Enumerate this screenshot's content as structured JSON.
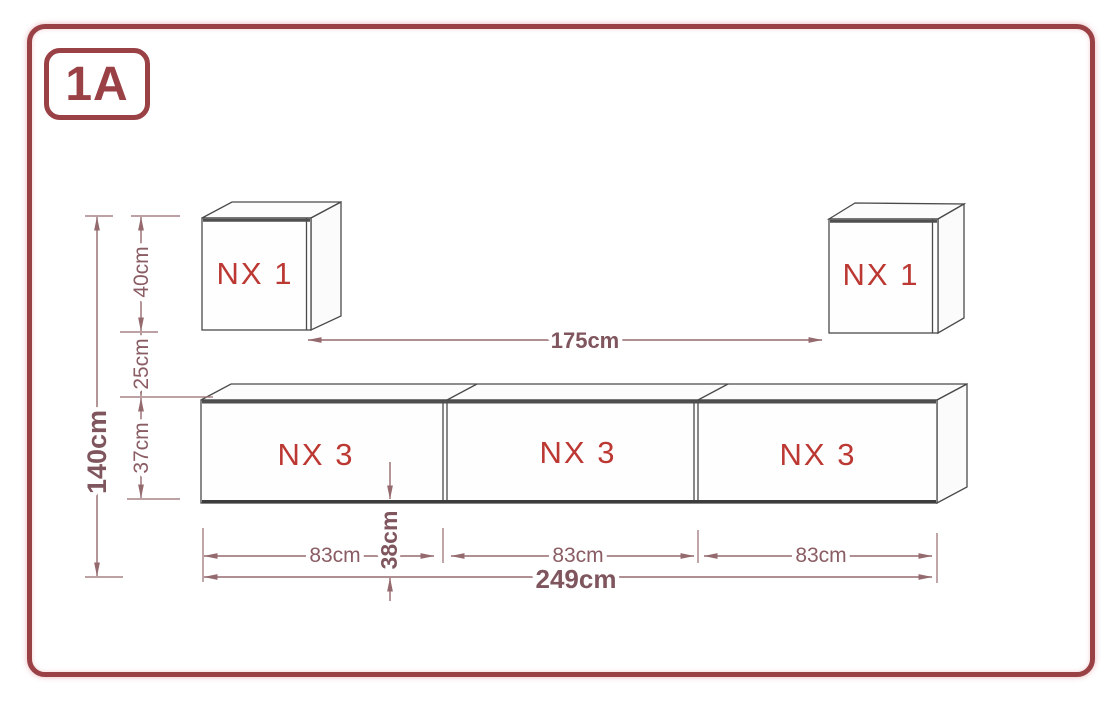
{
  "badge": {
    "label": "1A"
  },
  "furniture": {
    "wall_cubes": [
      {
        "label": "NX 1"
      },
      {
        "label": "NX 1"
      }
    ],
    "tv_cabinets": [
      {
        "label": "NX 3"
      },
      {
        "label": "NX 3"
      },
      {
        "label": "NX 3"
      }
    ]
  },
  "dimensions": {
    "total_height": "140cm",
    "cube_height": "40cm",
    "cube_to_cabinet_gap": "25cm",
    "cabinet_height": "37cm",
    "cubes_inner_span": "175cm",
    "cabinet_bottom_offset": "38cm",
    "cabinet_widths": [
      "83cm",
      "83cm",
      "83cm"
    ],
    "total_width": "249cm"
  },
  "colors": {
    "frame": "#9a4146",
    "label-red": "#bc3833",
    "dim": "#956a6e",
    "dim-text": "#8a5c63",
    "outline": "#4a4a4a"
  }
}
